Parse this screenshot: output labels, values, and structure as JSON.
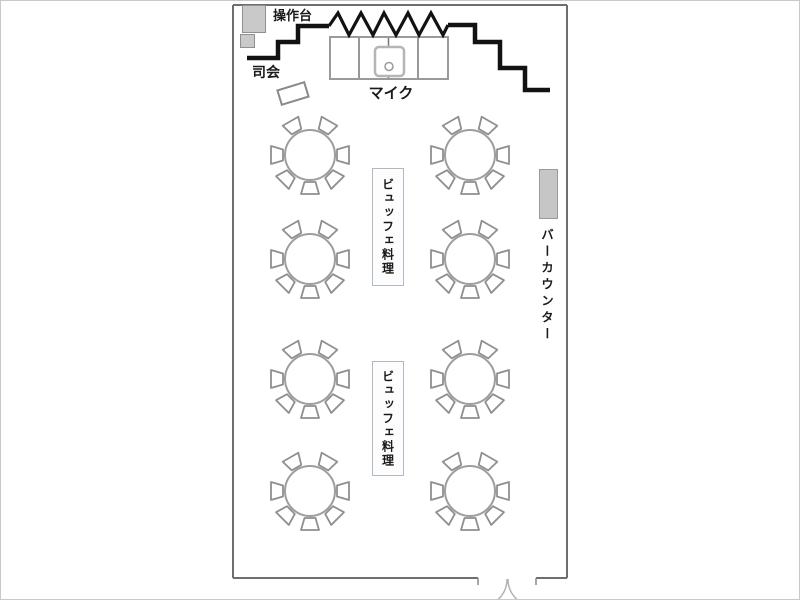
{
  "diagram": {
    "type": "banquet-room-floorplan",
    "background": "#ffffff",
    "wall_color": "#6e6e6e",
    "stage_line_color": "#121212",
    "furniture_fill": "#c9c9c9",
    "buffet_border_color": "#aebbc6"
  },
  "labels": {
    "control_desk": "操作台",
    "mc": "司会",
    "mic": "マイク",
    "bar_counter": "バーカウンター"
  },
  "stage": {
    "sections": 4,
    "has_mic_stand": true
  },
  "tables": {
    "count": 8,
    "chairs_per_table": 7,
    "columns_x": [
      309,
      469
    ],
    "rows_y": [
      154,
      258,
      378,
      490
    ],
    "radius": 25,
    "chair_angles_deg": [
      0,
      45,
      90,
      135,
      180,
      240,
      300
    ]
  },
  "buffet_tables": [
    {
      "label": "ビュッフェ料理"
    },
    {
      "label": "ビュッフェ料理"
    }
  ],
  "bar_counter": {
    "label": "バーカウンター"
  },
  "door": {
    "type": "double-swing",
    "location": "bottom-right"
  }
}
